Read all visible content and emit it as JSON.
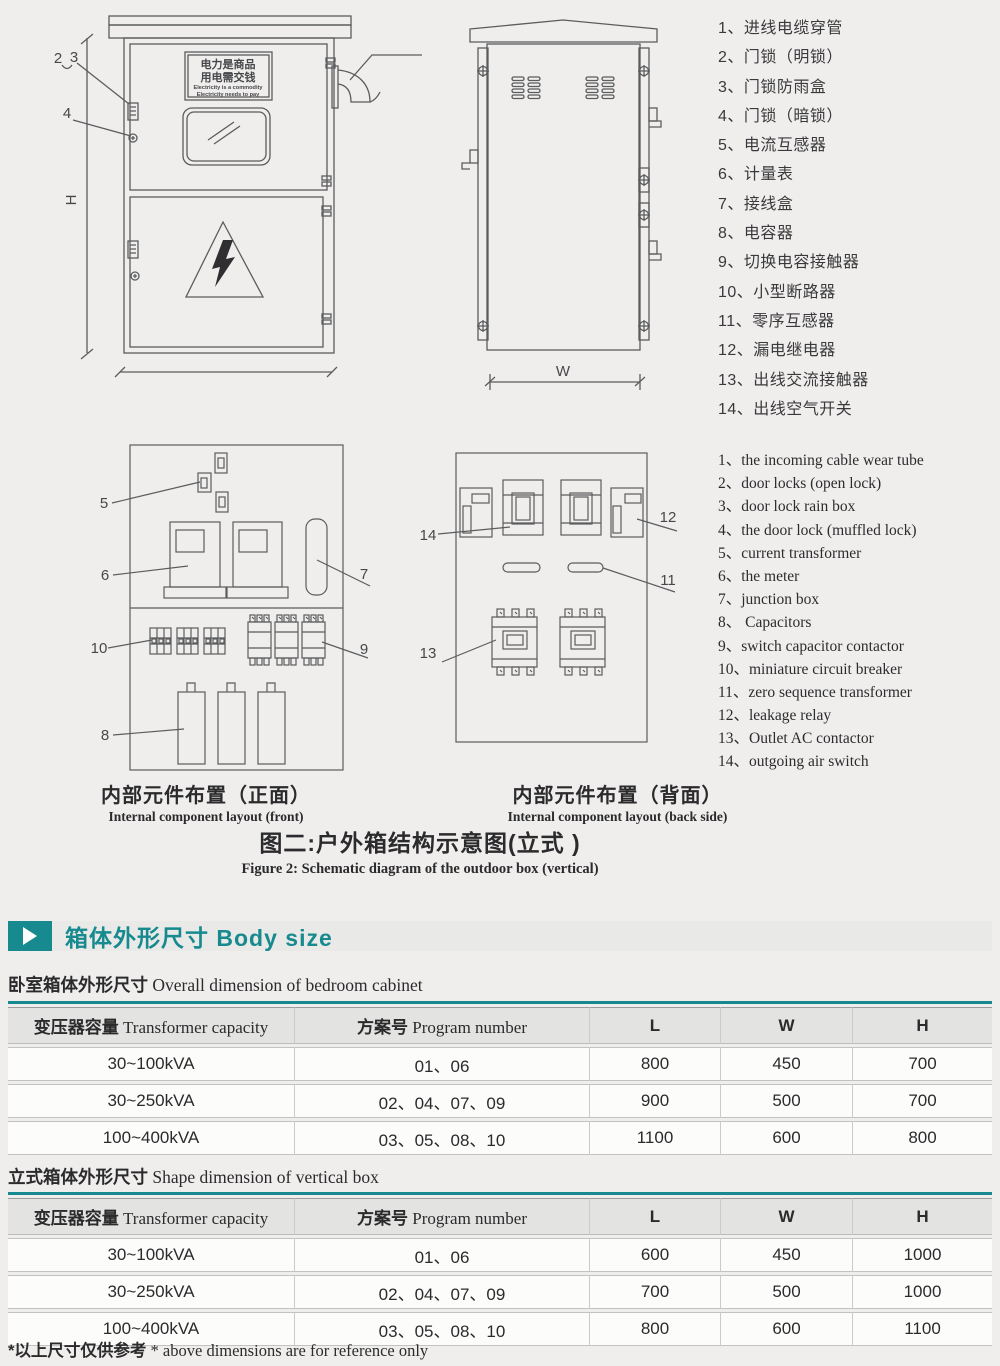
{
  "colors": {
    "accent_teal": "#168a8e",
    "page_bg": "#efeeed",
    "line": "#5b5c5e"
  },
  "figure": {
    "front_view": {
      "callout_2": "2",
      "callout_3": "3",
      "callout_4": "4",
      "dim_height": "H",
      "sign_line1_cn": "电力是商品",
      "sign_line2_cn": "用电需交钱",
      "sign_line1_en": "Electricity is a commodity",
      "sign_line2_en": "Electricity needs to pay"
    },
    "back_view": {
      "dim_width": "W"
    },
    "layout_front": {
      "callout_5": "5",
      "callout_6": "6",
      "callout_7": "7",
      "callout_8": "8",
      "callout_9": "9",
      "callout_10": "10",
      "caption_cn": "内部元件布置（正面）",
      "caption_en": "Internal component layout (front)"
    },
    "layout_back": {
      "callout_11": "11",
      "callout_12": "12",
      "callout_13": "13",
      "callout_14": "14",
      "caption_cn": "内部元件布置（背面）",
      "caption_en": "Internal component layout (back side)"
    },
    "caption_cn": "图二:户外箱结构示意图(立式 )",
    "caption_en": "Figure 2: Schematic diagram of the outdoor box (vertical)"
  },
  "legend_cn": [
    "1、进线电缆穿管",
    "2、门锁（明锁）",
    "3、门锁防雨盒",
    "4、门锁（暗锁）",
    "5、电流互感器",
    "6、计量表",
    "7、接线盒",
    "8、电容器",
    "9、切换电容接触器",
    "10、小型断路器",
    "11、零序互感器",
    "12、漏电继电器",
    "13、出线交流接触器",
    "14、出线空气开关"
  ],
  "legend_en": [
    "1、the incoming cable wear tube",
    "2、door locks (open lock)",
    "3、door lock rain box",
    "4、the door lock (muffled lock)",
    "5、current transformer",
    "6、the meter",
    "7、junction box",
    "8、 Capacitors",
    "9、switch capacitor contactor",
    "10、miniature circuit breaker",
    "11、zero sequence transformer",
    "12、leakage relay",
    "13、Outlet AC contactor",
    "14、outgoing air switch"
  ],
  "body_size": {
    "section_title": "箱体外形尺寸 Body size",
    "table1": {
      "subtitle_cn": "卧室箱体外形尺寸",
      "subtitle_en": " Overall dimension of bedroom cabinet",
      "headers": [
        {
          "cn": "变压器容量",
          "en": " Transformer capacity"
        },
        {
          "cn": "方案号",
          "en": " Program number"
        },
        {
          "cn": "L",
          "en": ""
        },
        {
          "cn": "W",
          "en": ""
        },
        {
          "cn": "H",
          "en": ""
        }
      ],
      "rows": [
        [
          "30~100kVA",
          "01、06",
          "800",
          "450",
          "700"
        ],
        [
          "30~250kVA",
          "02、04、07、09",
          "900",
          "500",
          "700"
        ],
        [
          "100~400kVA",
          "03、05、08、10",
          "1100",
          "600",
          "800"
        ]
      ]
    },
    "table2": {
      "subtitle_cn": "立式箱体外形尺寸",
      "subtitle_en": " Shape dimension of vertical box",
      "headers": [
        {
          "cn": "变压器容量",
          "en": " Transformer capacity"
        },
        {
          "cn": "方案号",
          "en": " Program number"
        },
        {
          "cn": "L",
          "en": ""
        },
        {
          "cn": "W",
          "en": ""
        },
        {
          "cn": "H",
          "en": ""
        }
      ],
      "rows": [
        [
          "30~100kVA",
          "01、06",
          "600",
          "450",
          "1000"
        ],
        [
          "30~250kVA",
          "02、04、07、09",
          "700",
          "500",
          "1000"
        ],
        [
          "100~400kVA",
          "03、05、08、10",
          "800",
          "600",
          "1100"
        ]
      ]
    },
    "footnote_cn": "*以上尺寸仅供参考",
    "footnote_en": " * above dimensions are for reference only"
  }
}
